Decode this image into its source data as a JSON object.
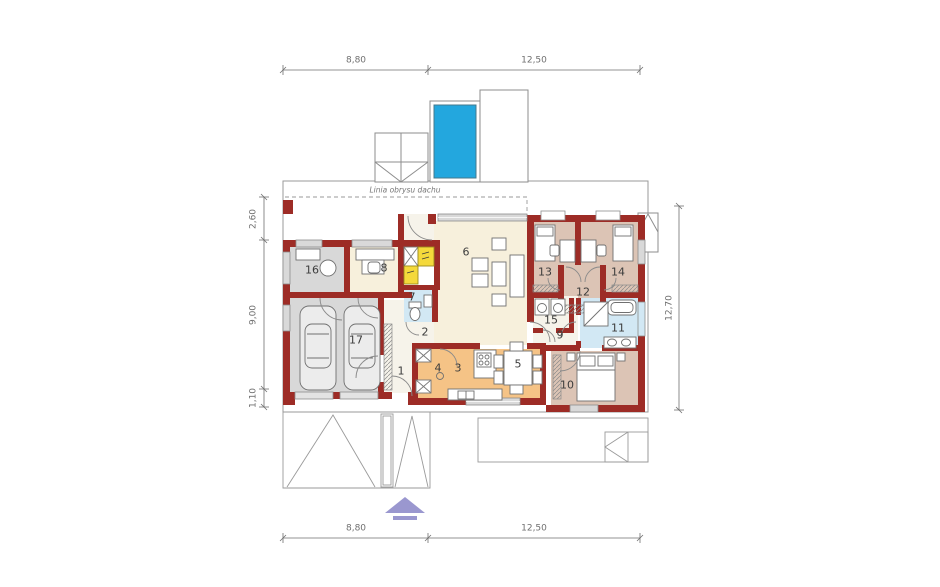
{
  "plan": {
    "roof_outline_label": "Linia obrysu dachu",
    "rooms": [
      {
        "number": "1"
      },
      {
        "number": "2"
      },
      {
        "number": "3"
      },
      {
        "number": "4"
      },
      {
        "number": "5"
      },
      {
        "number": "6"
      },
      {
        "number": "7"
      },
      {
        "number": "8"
      },
      {
        "number": "9"
      },
      {
        "number": "10"
      },
      {
        "number": "11"
      },
      {
        "number": "12"
      },
      {
        "number": "13"
      },
      {
        "number": "14"
      },
      {
        "number": "15"
      },
      {
        "number": "16"
      },
      {
        "number": "17"
      }
    ],
    "dims": {
      "top": [
        "8,80",
        "12,50"
      ],
      "bottom": [
        "8,80",
        "12,50"
      ],
      "left": [
        "2,60",
        "9,00",
        "1,10"
      ],
      "right": [
        "12,70"
      ]
    },
    "colors": {
      "wall": "#9d2c26",
      "floor": "#f7f0dc",
      "grey": "#d8d8d8",
      "tan": "#dcc4b5",
      "orange": "#f5c386",
      "blue": "#d2e8f4",
      "pale": "#f6f3ea",
      "pool": "#23a7de",
      "yellow": "#f4d93b",
      "line": "#9a9a9a",
      "dim": "#6f6f6f",
      "furn": "#707070",
      "arrow": "#9a97cf",
      "window": "#d9d9d9"
    }
  }
}
